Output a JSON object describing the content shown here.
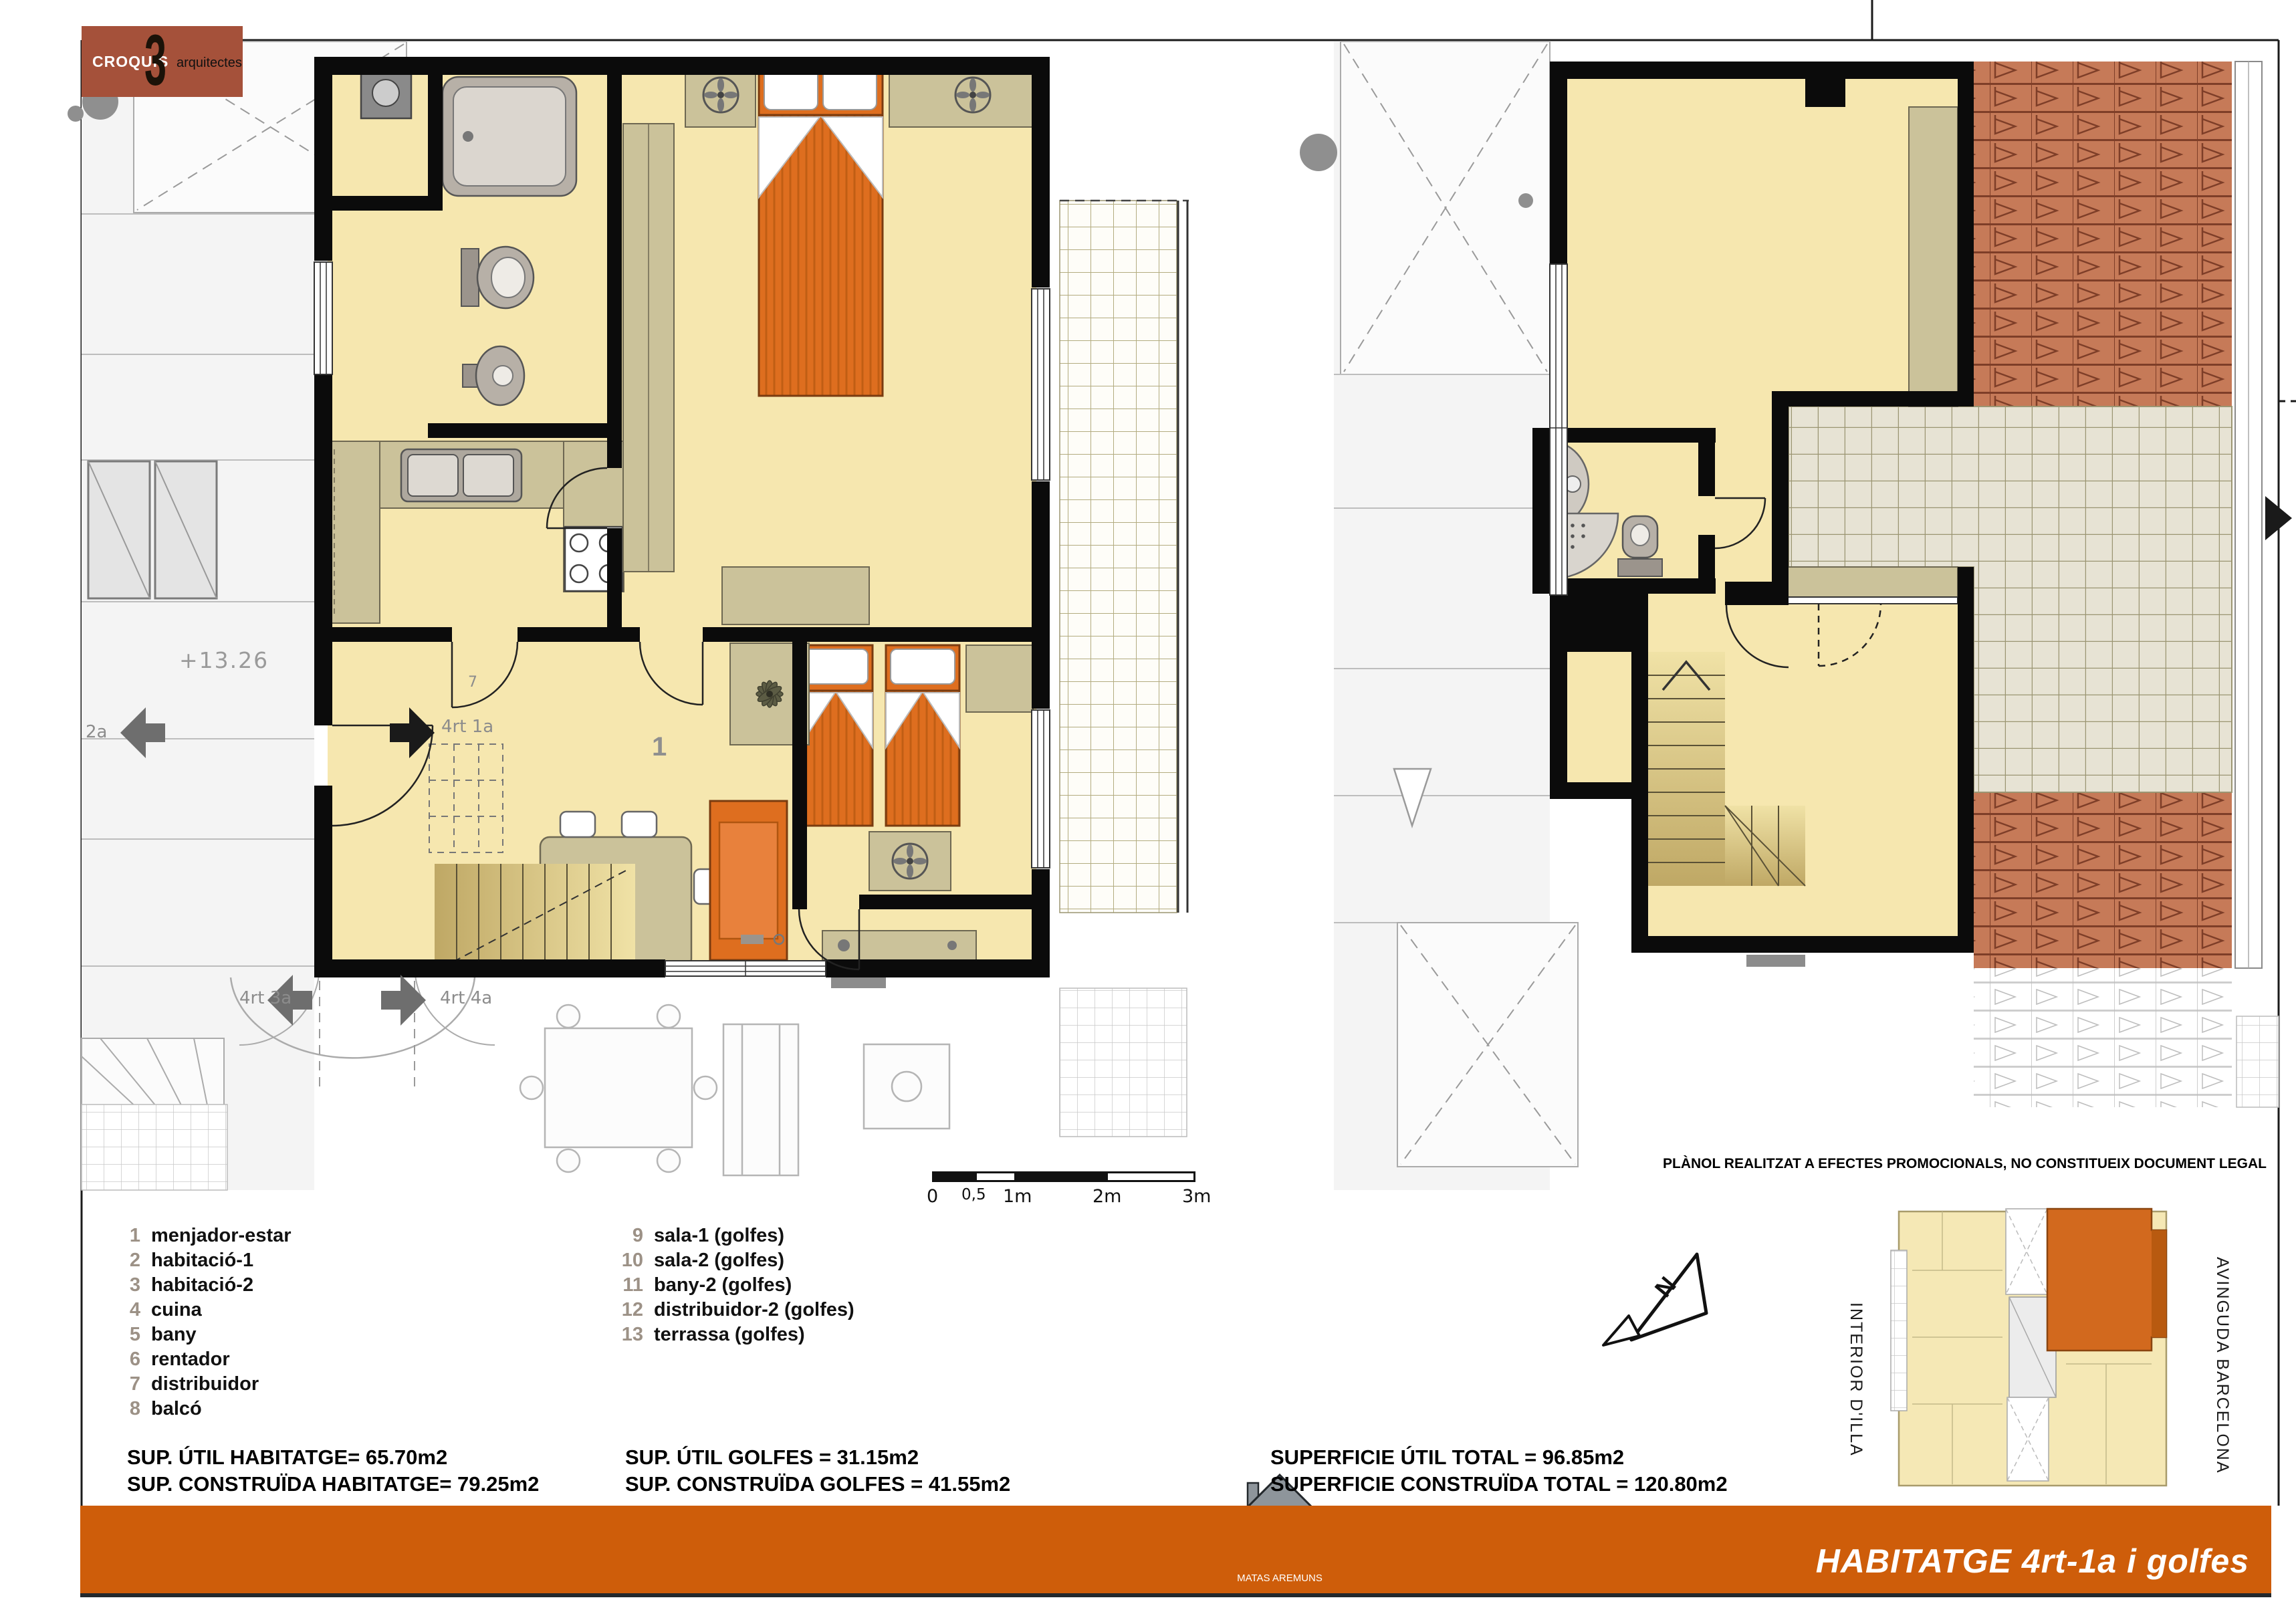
{
  "logo": {
    "croquis": "CROQUIS",
    "three": "3",
    "arquitectes": "arquitectes"
  },
  "plan_labels": {
    "level": "+13.26",
    "neighbor_2a": "2a",
    "unit_4rt_1a": "4rt 1a",
    "room_1": "1",
    "room_7": "7",
    "neighbor_4rt_3a": "4rt 3a",
    "neighbor_4rt_4a": "4rt 4a"
  },
  "scalebar": {
    "labels": [
      "0",
      "0,5",
      "1m",
      "2m",
      "3m"
    ]
  },
  "disclaimer": "PLÀNOL REALITZAT A EFECTES PROMOCIONALS, NO CONSTITUEIX DOCUMENT LEGAL",
  "legend": {
    "column1": [
      {
        "num": "1",
        "label": "menjador-estar"
      },
      {
        "num": "2",
        "label": "habitació-1"
      },
      {
        "num": "3",
        "label": "habitació-2"
      },
      {
        "num": "4",
        "label": "cuina"
      },
      {
        "num": "5",
        "label": "bany"
      },
      {
        "num": "6",
        "label": "rentador"
      },
      {
        "num": "7",
        "label": "distribuidor"
      },
      {
        "num": "8",
        "label": "balcó"
      }
    ],
    "column2": [
      {
        "num": "9",
        "label": "sala-1 (golfes)"
      },
      {
        "num": "10",
        "label": "sala-2 (golfes)"
      },
      {
        "num": "11",
        "label": "bany-2 (golfes)"
      },
      {
        "num": "12",
        "label": "distribuidor-2 (golfes)"
      },
      {
        "num": "13",
        "label": "terrassa (golfes)"
      }
    ]
  },
  "areas": {
    "habitatge": [
      "SUP. ÚTIL HABITATGE= 65.70m2",
      "SUP. CONSTRUÏDA HABITATGE= 79.25m2"
    ],
    "golfes": [
      "SUP. ÚTIL GOLFES = 31.15m2",
      "SUP. CONSTRUÏDA GOLFES = 41.55m2"
    ],
    "total": [
      "SUPERFICIE ÚTIL TOTAL = 96.85m2",
      "SUPERFICIE CONSTRUÏDA TOTAL = 120.80m2"
    ]
  },
  "keyplan": {
    "left_street": "INTERIOR D'ILLA",
    "right_street": "AVINGUDA BARCELONA"
  },
  "compass": {
    "label": "N"
  },
  "footer": {
    "builder": "MATAS AREMUNS",
    "title": "HABITATGE 4rt-1a i golfes"
  },
  "colors": {
    "footer_orange": "#CE5D0A",
    "logo_rust": "#A5513A",
    "room_fill": "#F6E7AF",
    "furniture_khaki": "#CBC29A",
    "bed_orange": "#DE6E1F",
    "roof_terracotta": "#C67A58",
    "legend_number": "#9C9186"
  }
}
